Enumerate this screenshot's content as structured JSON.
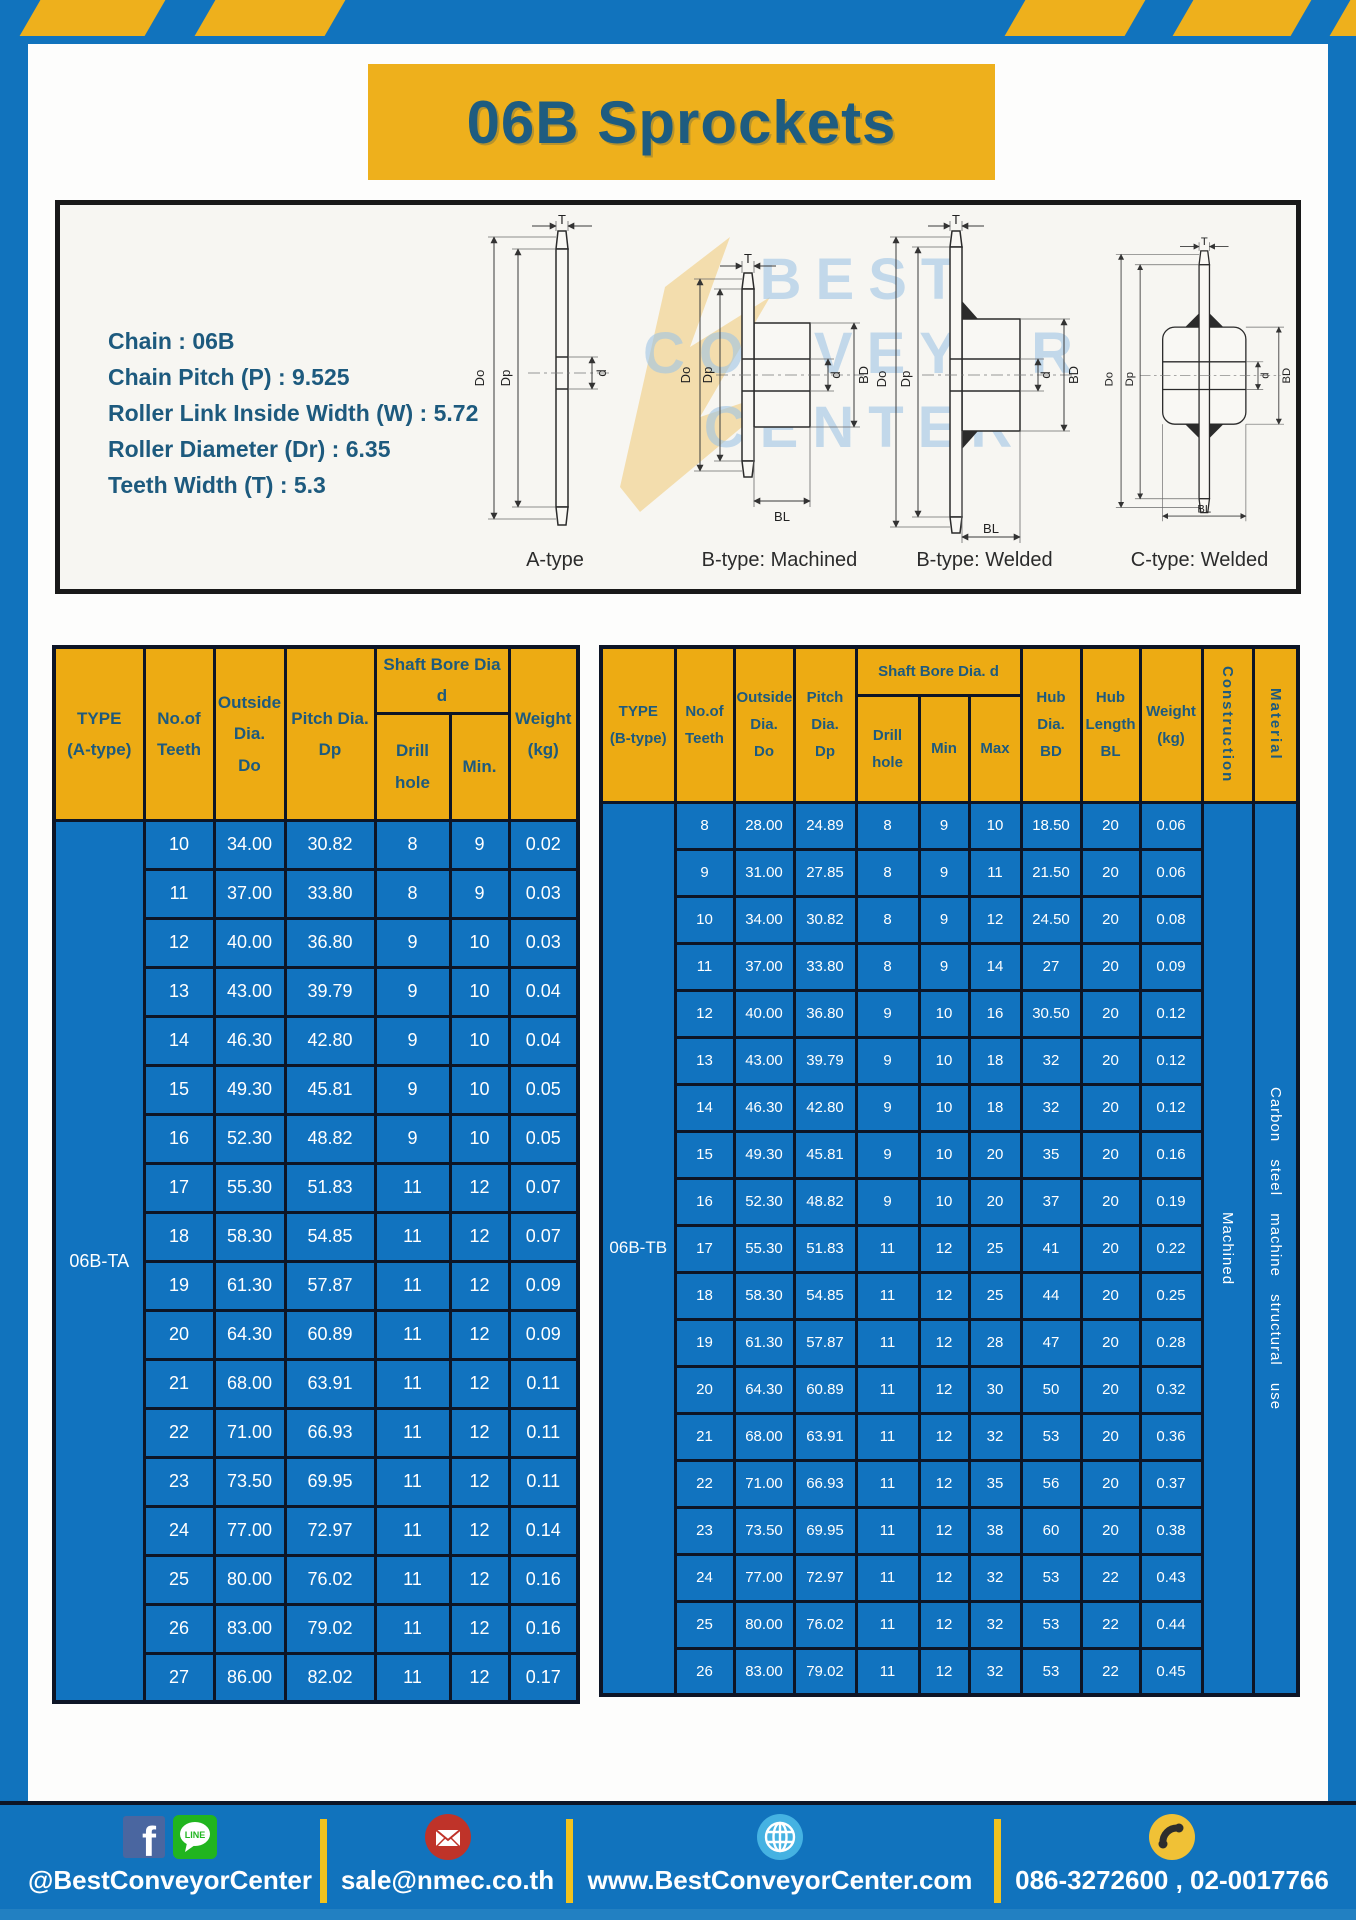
{
  "title": "06B Sprockets",
  "spec_box": {
    "lines": [
      "Chain  : 06B",
      "Chain Pitch (P)  :  9.525",
      "Roller Link Inside Width (W)  :  5.72",
      "Roller Diameter (Dr)  : 6.35",
      "Teeth Width (T)  :  5.3"
    ]
  },
  "watermark": {
    "line1": "BEST",
    "line2": "CONVEYOR",
    "line3": "CENTER"
  },
  "drawings": {
    "captions": [
      "A-type",
      "B-type: Machined",
      "B-type: Welded",
      "C-type: Welded"
    ],
    "dim_labels": {
      "T": "T",
      "Do": "Do",
      "Dp": "Dp",
      "d": "d",
      "BD": "BD",
      "BL": "BL"
    }
  },
  "table_a": {
    "headers": {
      "type": "TYPE\n(A-type)",
      "teeth": "No.of\nTeeth",
      "outside": "Outside\nDia.\nDo",
      "pitch": "Pitch Dia.\nDp",
      "shaft_bore": "Shaft Bore Dia d",
      "drill": "Drill hole",
      "min": "Min.",
      "weight": "Weight\n(kg)"
    },
    "type_label": "06B-TA",
    "rows": [
      [
        "10",
        "34.00",
        "30.82",
        "8",
        "9",
        "0.02"
      ],
      [
        "11",
        "37.00",
        "33.80",
        "8",
        "9",
        "0.03"
      ],
      [
        "12",
        "40.00",
        "36.80",
        "9",
        "10",
        "0.03"
      ],
      [
        "13",
        "43.00",
        "39.79",
        "9",
        "10",
        "0.04"
      ],
      [
        "14",
        "46.30",
        "42.80",
        "9",
        "10",
        "0.04"
      ],
      [
        "15",
        "49.30",
        "45.81",
        "9",
        "10",
        "0.05"
      ],
      [
        "16",
        "52.30",
        "48.82",
        "9",
        "10",
        "0.05"
      ],
      [
        "17",
        "55.30",
        "51.83",
        "11",
        "12",
        "0.07"
      ],
      [
        "18",
        "58.30",
        "54.85",
        "11",
        "12",
        "0.07"
      ],
      [
        "19",
        "61.30",
        "57.87",
        "11",
        "12",
        "0.09"
      ],
      [
        "20",
        "64.30",
        "60.89",
        "11",
        "12",
        "0.09"
      ],
      [
        "21",
        "68.00",
        "63.91",
        "11",
        "12",
        "0.11"
      ],
      [
        "22",
        "71.00",
        "66.93",
        "11",
        "12",
        "0.11"
      ],
      [
        "23",
        "73.50",
        "69.95",
        "11",
        "12",
        "0.11"
      ],
      [
        "24",
        "77.00",
        "72.97",
        "11",
        "12",
        "0.14"
      ],
      [
        "25",
        "80.00",
        "76.02",
        "11",
        "12",
        "0.16"
      ],
      [
        "26",
        "83.00",
        "79.02",
        "11",
        "12",
        "0.16"
      ],
      [
        "27",
        "86.00",
        "82.02",
        "11",
        "12",
        "0.17"
      ]
    ]
  },
  "table_b": {
    "headers": {
      "type": "TYPE\n(B-type)",
      "teeth": "No.of\nTeeth",
      "outside": "Outside\nDia.\nDo",
      "pitch": "Pitch\nDia.\nDp",
      "shaft_bore": "Shaft Bore Dia.  d",
      "drill": "Drill hole",
      "min": "Min",
      "max": "Max",
      "hub_dia": "Hub\nDia.\nBD",
      "hub_len": "Hub\nLength\nBL",
      "weight": "Weight\n(kg)",
      "construction": "Construction",
      "material": "Material"
    },
    "type_label": "06B-TB",
    "construction_value": "Machined",
    "material_value": "Carbon steel machine structural use",
    "rows": [
      [
        "8",
        "28.00",
        "24.89",
        "8",
        "9",
        "10",
        "18.50",
        "20",
        "0.06"
      ],
      [
        "9",
        "31.00",
        "27.85",
        "8",
        "9",
        "11",
        "21.50",
        "20",
        "0.06"
      ],
      [
        "10",
        "34.00",
        "30.82",
        "8",
        "9",
        "12",
        "24.50",
        "20",
        "0.08"
      ],
      [
        "11",
        "37.00",
        "33.80",
        "8",
        "9",
        "14",
        "27",
        "20",
        "0.09"
      ],
      [
        "12",
        "40.00",
        "36.80",
        "9",
        "10",
        "16",
        "30.50",
        "20",
        "0.12"
      ],
      [
        "13",
        "43.00",
        "39.79",
        "9",
        "10",
        "18",
        "32",
        "20",
        "0.12"
      ],
      [
        "14",
        "46.30",
        "42.80",
        "9",
        "10",
        "18",
        "32",
        "20",
        "0.12"
      ],
      [
        "15",
        "49.30",
        "45.81",
        "9",
        "10",
        "20",
        "35",
        "20",
        "0.16"
      ],
      [
        "16",
        "52.30",
        "48.82",
        "9",
        "10",
        "20",
        "37",
        "20",
        "0.19"
      ],
      [
        "17",
        "55.30",
        "51.83",
        "11",
        "12",
        "25",
        "41",
        "20",
        "0.22"
      ],
      [
        "18",
        "58.30",
        "54.85",
        "11",
        "12",
        "25",
        "44",
        "20",
        "0.25"
      ],
      [
        "19",
        "61.30",
        "57.87",
        "11",
        "12",
        "28",
        "47",
        "20",
        "0.28"
      ],
      [
        "20",
        "64.30",
        "60.89",
        "11",
        "12",
        "30",
        "50",
        "20",
        "0.32"
      ],
      [
        "21",
        "68.00",
        "63.91",
        "11",
        "12",
        "32",
        "53",
        "20",
        "0.36"
      ],
      [
        "22",
        "71.00",
        "66.93",
        "11",
        "12",
        "35",
        "56",
        "20",
        "0.37"
      ],
      [
        "23",
        "73.50",
        "69.95",
        "11",
        "12",
        "38",
        "60",
        "20",
        "0.38"
      ],
      [
        "24",
        "77.00",
        "72.97",
        "11",
        "12",
        "32",
        "53",
        "22",
        "0.43"
      ],
      [
        "25",
        "80.00",
        "76.02",
        "11",
        "12",
        "32",
        "53",
        "22",
        "0.44"
      ],
      [
        "26",
        "83.00",
        "79.02",
        "11",
        "12",
        "32",
        "53",
        "22",
        "0.45"
      ]
    ]
  },
  "footer": {
    "social_handle": "@BestConveyorCenter",
    "email": "sale@nmec.co.th",
    "website": "www.BestConveyorCenter.com",
    "phones": "086-3272600 , 02-0017766",
    "fb_letter": "f",
    "line_label": "LINE"
  },
  "colors": {
    "frame_blue": "#1173bd",
    "accent_yellow": "#eeb01c",
    "header_gold": "#edab13",
    "cell_blue": "#1173bf",
    "dark_blue_text": "#1d5a7e",
    "table_border": "#0d1526"
  }
}
